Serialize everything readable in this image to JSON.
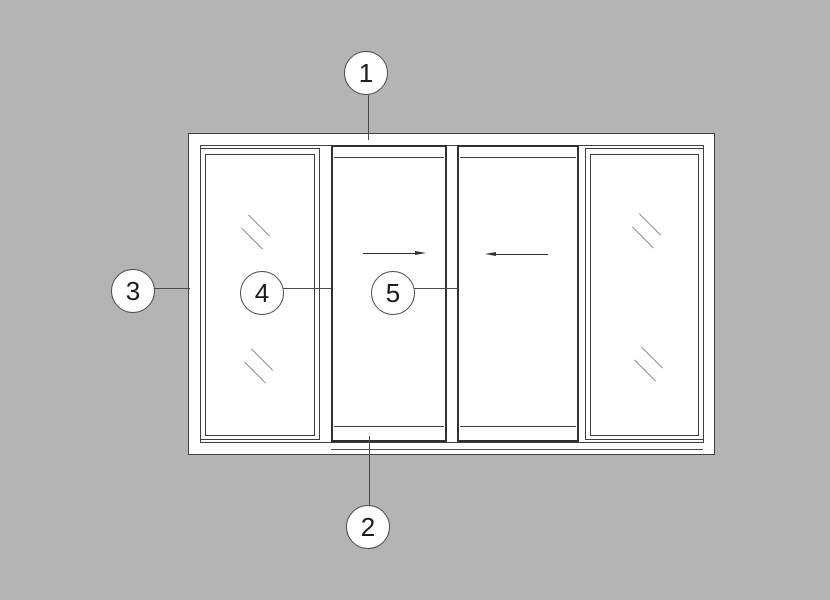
{
  "callouts": [
    {
      "label": "1"
    },
    {
      "label": "2"
    },
    {
      "label": "3"
    },
    {
      "label": "4"
    },
    {
      "label": "5"
    }
  ],
  "arrows": [
    {
      "direction": "right"
    },
    {
      "direction": "left"
    }
  ],
  "icons": {
    "glass_hatch": "\\\\",
    "arrow_right": "→",
    "arrow_left": "←"
  },
  "colors": {
    "background": "#b4b4b4",
    "paper": "#ffffff",
    "line": "#3f3f3f",
    "heavy_line": "#2f2f2f",
    "leader": "#4a4a4a",
    "hatch": "#8f8f8f",
    "text": "#1c1c1c"
  }
}
